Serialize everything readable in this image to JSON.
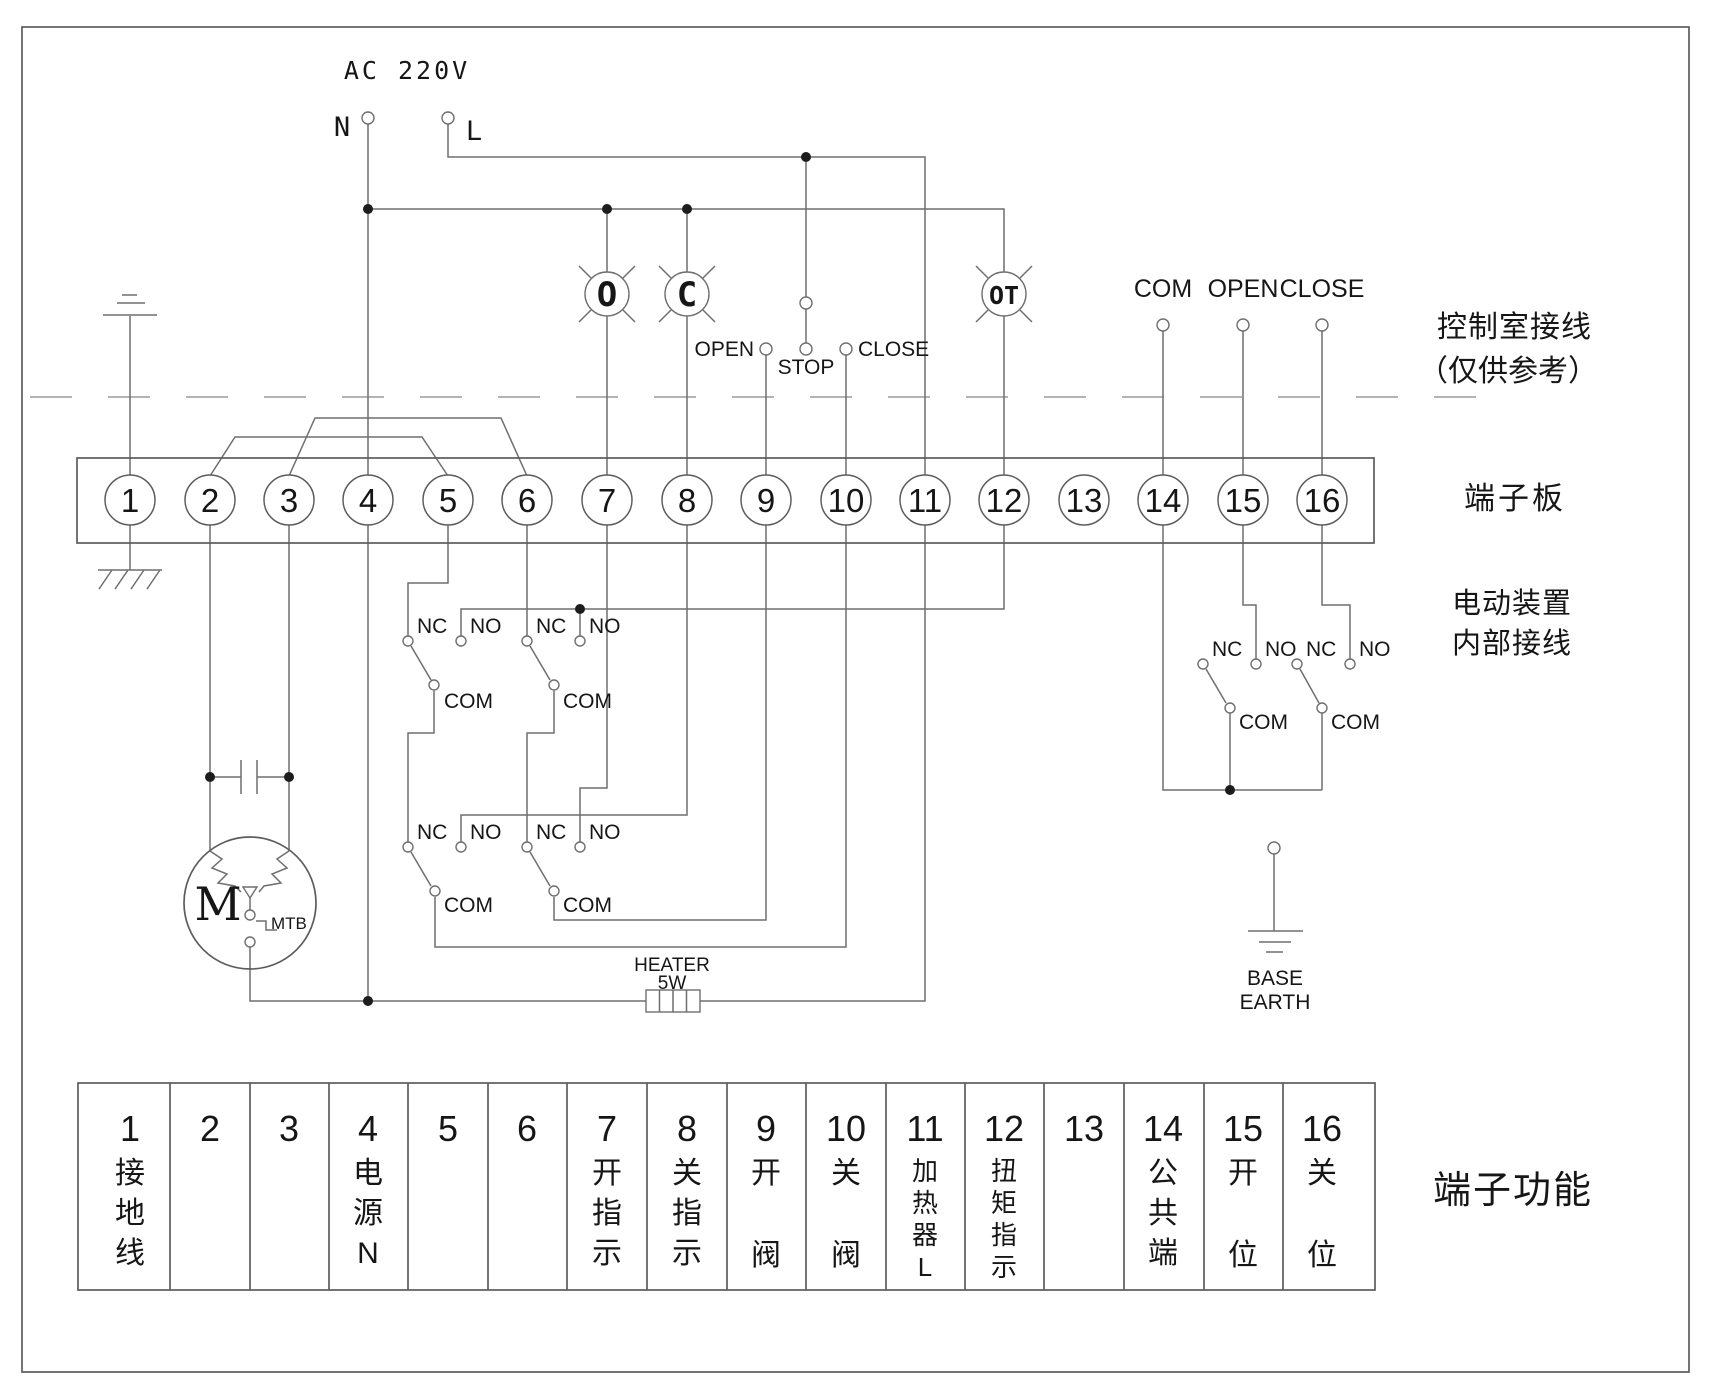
{
  "power": {
    "label": "AC 220V",
    "neutral": "N",
    "line": "L"
  },
  "lamps": {
    "open": "O",
    "close": "C",
    "torque": "OT"
  },
  "pushbuttons": {
    "open": "OPEN",
    "stop": "STOP",
    "close": "CLOSE"
  },
  "remote": {
    "com": "COM",
    "open": "OPEN",
    "close": "CLOSE"
  },
  "contacts": {
    "nc": "NC",
    "no": "NO",
    "com": "COM"
  },
  "motor": {
    "m": "M",
    "mtb": "MTB"
  },
  "heater": {
    "name": "HEATER",
    "power": "5W"
  },
  "base_earth": {
    "line1": "BASE",
    "line2": "EARTH"
  },
  "annotations": {
    "control_room": "控制室接线",
    "reference_only": "（仅供参考）",
    "terminal_board": "端子板",
    "device_line1": "电动装置",
    "device_line2": "内部接线",
    "table_title": "端子功能"
  },
  "terminals": [
    "1",
    "2",
    "3",
    "4",
    "5",
    "6",
    "7",
    "8",
    "9",
    "10",
    "11",
    "12",
    "13",
    "14",
    "15",
    "16"
  ],
  "functions": [
    {
      "num": "1",
      "label": "接地线"
    },
    {
      "num": "2",
      "label": ""
    },
    {
      "num": "3",
      "label": ""
    },
    {
      "num": "4",
      "label": "电源N"
    },
    {
      "num": "5",
      "label": ""
    },
    {
      "num": "6",
      "label": ""
    },
    {
      "num": "7",
      "label": "开指示"
    },
    {
      "num": "8",
      "label": "关指示"
    },
    {
      "num": "9",
      "label": "开阀"
    },
    {
      "num": "10",
      "label": "关阀"
    },
    {
      "num": "11",
      "label": "加热器L"
    },
    {
      "num": "12",
      "label": "扭矩指示"
    },
    {
      "num": "13",
      "label": ""
    },
    {
      "num": "14",
      "label": "公共端"
    },
    {
      "num": "15",
      "label": "开位"
    },
    {
      "num": "16",
      "label": "关位"
    }
  ]
}
